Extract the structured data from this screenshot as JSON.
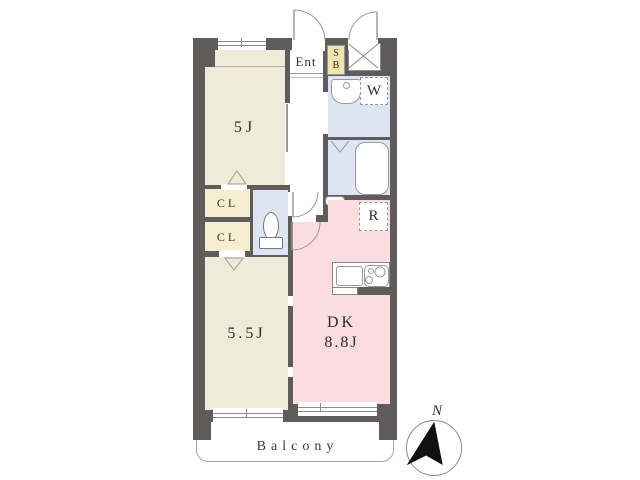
{
  "floor_plan": {
    "rooms": {
      "bedroom_top": {
        "label": "5J"
      },
      "bedroom_bottom": {
        "label": "5.5J"
      },
      "dining_kitchen": {
        "label": "DK",
        "size": "8.8J"
      },
      "entrance": {
        "label": "Ent"
      },
      "closet_top": {
        "label": "CL"
      },
      "closet_bottom": {
        "label": "CL"
      },
      "shoe_box": {
        "letters": [
          "S",
          "B"
        ]
      },
      "washing_machine": {
        "label": "W"
      },
      "refrigerator": {
        "label": "R"
      }
    },
    "balcony": {
      "label": "Balcony"
    },
    "compass": {
      "label": "N"
    },
    "fixtures": [
      "toilet",
      "washbasin",
      "bathtub",
      "kitchen-sink",
      "stove-burners",
      "pipe-space-x",
      "entrance-door",
      "service-door",
      "folding-doors",
      "sliding-doors",
      "windows"
    ]
  },
  "colors": {
    "wall": "#605c5c",
    "room_beige": "#f0ead9",
    "closet_yellow": "#f5efcf",
    "shoebox_yellow": "#efe6ad",
    "wet_area_blue": "#dde4f2",
    "dk_pink": "#fbdce1",
    "line_gray": "#9a9a9a"
  }
}
